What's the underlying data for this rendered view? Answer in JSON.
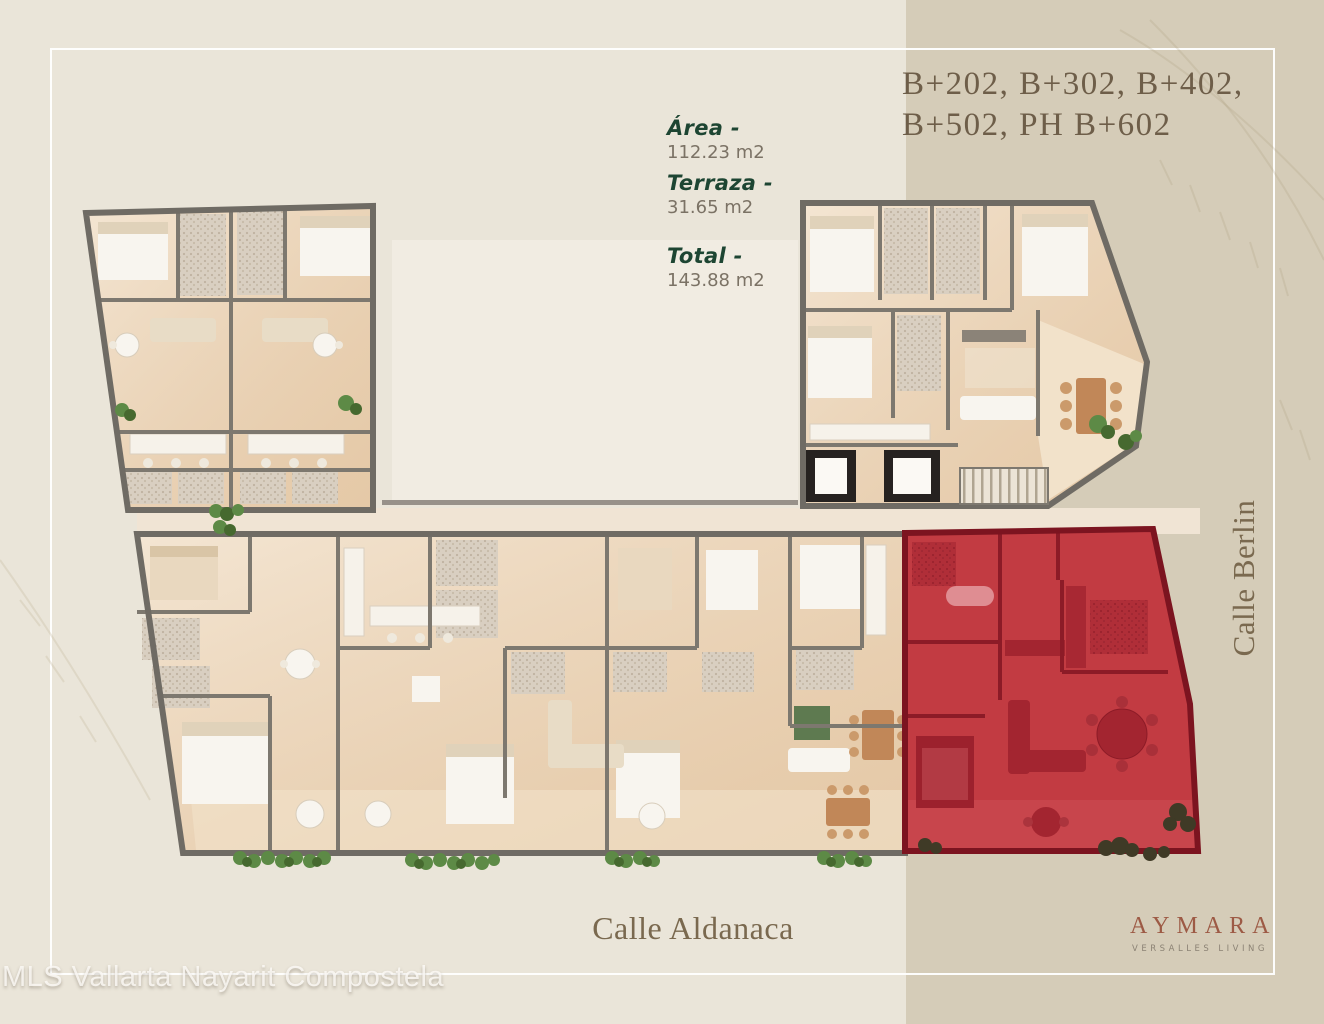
{
  "page": {
    "background": "#eae5d9",
    "side_panel_color": "#d5ccb8",
    "frame_color": "#ffffff"
  },
  "header": {
    "line1": "B+202, B+302, B+402,",
    "line2": "B+502, PH B+602",
    "text_color": "#6e5e49"
  },
  "stats": {
    "items": [
      {
        "label": "Área -",
        "value": "112.23 m2"
      },
      {
        "label": "Terraza -",
        "value": "31.65 m2"
      },
      {
        "label": "Total -",
        "value": "143.88 m2"
      }
    ],
    "label_color": "#1d4532",
    "value_color": "#7b7265"
  },
  "streets": {
    "right": "Calle Berlin",
    "bottom": "Calle Aldanaca",
    "text_color": "#7a694f"
  },
  "watermark": {
    "text": "MLS Vallarta Nayarit Compostela"
  },
  "brand": {
    "name": "AYMARA",
    "tagline": "VERSALLES LIVING",
    "name_color": "#9d5a45",
    "tagline_color": "#8b8274"
  },
  "floorplan": {
    "highlight_color": "#c23b42",
    "highlight_wall_color": "#7c1420",
    "floor_color": "#eed8bb",
    "wall_color": "#6f6b64",
    "terrace_floor_color": "#f2e2ca",
    "greenery_color": "#5d8a46"
  }
}
